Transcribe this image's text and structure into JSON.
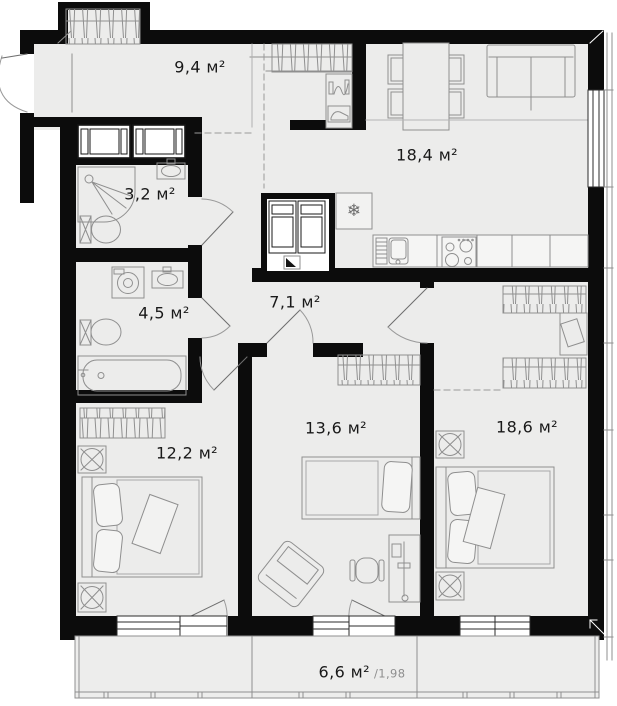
{
  "plan": {
    "rooms": {
      "hallway": {
        "area": "9,4 м²"
      },
      "living_kitchen": {
        "area": "18,4 м²"
      },
      "shower_room": {
        "area": "3,2 м²"
      },
      "bathroom": {
        "area": "4,5 м²"
      },
      "corridor": {
        "area": "7,1 м²"
      },
      "bedroom_left": {
        "area": "12,2 м²"
      },
      "bedroom_middle": {
        "area": "13,6 м²"
      },
      "bedroom_right": {
        "area": "18,6 м²"
      }
    },
    "balcony": {
      "area": "6,6 м²",
      "coefficient": "/1,98"
    },
    "icons": {
      "fridge_snowflake": "❄"
    },
    "colors": {
      "wall": "#0c0c0c",
      "floor": "#ececeb",
      "linework": "#8f8f8f"
    }
  }
}
